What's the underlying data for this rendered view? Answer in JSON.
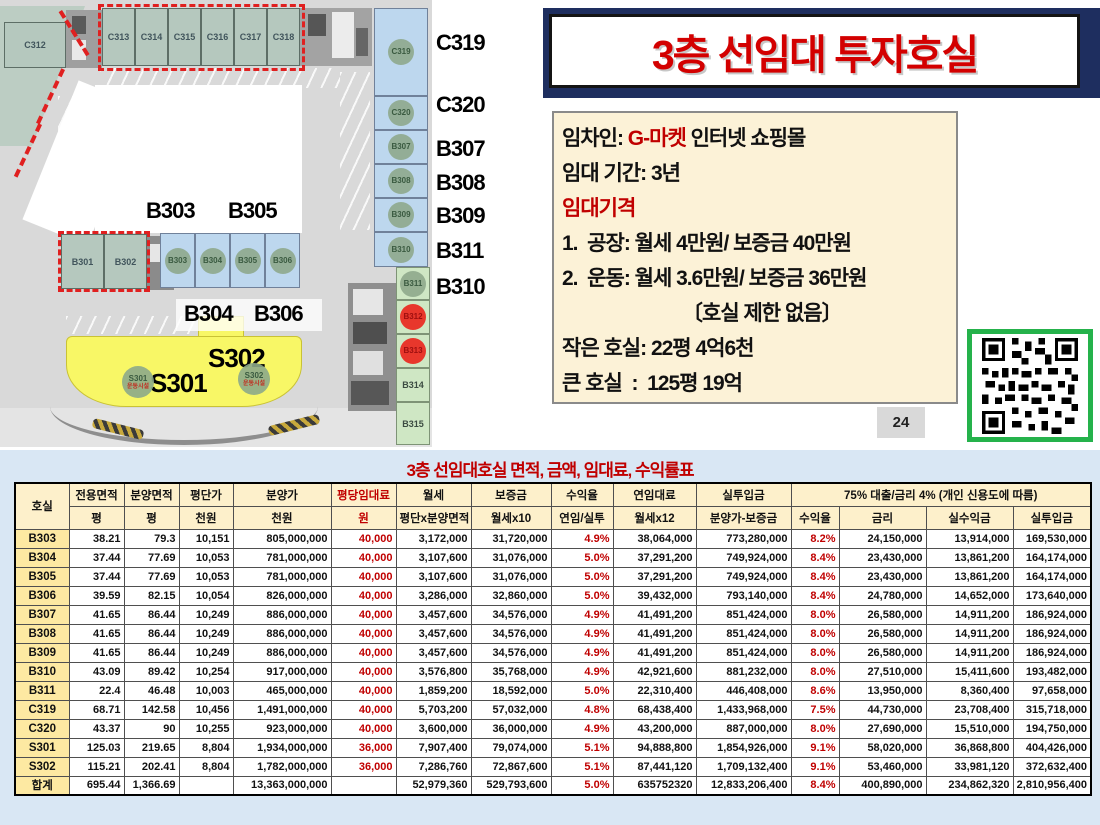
{
  "title": "3층 선임대 투자호실",
  "colors": {
    "title_red": "#d30000",
    "accent_red": "#c00000",
    "navy_frame": "#1e2e5f",
    "qr_border_green": "#25b24b",
    "info_bg": "#fcf2d7",
    "table_band_bg": "#d9e7f4",
    "header_cream": "#fdf0cb",
    "row_label_yellow": "#fde9a2"
  },
  "info_box": {
    "line1_label": "임차인: ",
    "line1_red": "G-마켓",
    "line1_rest": " 인터넷 쇼핑몰",
    "line2": "임대 기간: 3년",
    "line3": "임대기격",
    "line4": "1.  공장: 월세 4만원/ 보증금 40만원",
    "line5": "2.  운동: 월세 3.6만원/ 보증금 36만원",
    "line6": "〔호실 제한 없음〕",
    "line7": "작은 호실: 22평 4억6천",
    "line8": "큰 호실  :  125평 19억"
  },
  "page_number": "24",
  "qr_label": "상세보기",
  "floorplan": {
    "c312": "C312",
    "top_units": [
      "C313",
      "C314",
      "C315",
      "C316",
      "C317",
      "C318"
    ],
    "right_cells": [
      {
        "label": "C319",
        "kind": "blue-circle"
      },
      {
        "label": "C320",
        "kind": "blue-circle"
      },
      {
        "label": "B307",
        "kind": "blue-circle"
      },
      {
        "label": "B308",
        "kind": "blue-circle"
      },
      {
        "label": "B309",
        "kind": "blue-circle"
      },
      {
        "label": "B310",
        "kind": "blue-circle"
      },
      {
        "label": "B311",
        "kind": "green-circle"
      },
      {
        "label": "B312",
        "kind": "red-circle"
      },
      {
        "label": "B313",
        "kind": "red-circle"
      },
      {
        "label": "B314",
        "kind": "green-text"
      },
      {
        "label": "B315",
        "kind": "green-text"
      }
    ],
    "right_big_labels": [
      "C319",
      "C320",
      "B307",
      "B308",
      "B309",
      "B311",
      "B310"
    ],
    "inner_units": [
      "B303",
      "B304",
      "B305",
      "B306"
    ],
    "annex_units": [
      "B301",
      "B302"
    ],
    "label_b303": "B303",
    "label_b305": "B305",
    "label_b304": "B304",
    "label_b306": "B306",
    "s_units": [
      {
        "name": "S301",
        "sub": "운동시설"
      },
      {
        "name": "S302",
        "sub": "운동시설"
      }
    ],
    "label_s301": "S301",
    "label_s302": "S302"
  },
  "table": {
    "title": "3층 선임대호실 면적, 금액, 임대료, 수익률표",
    "group_header": "75% 대출/금리 4%  (개인 신용도에 따름)",
    "headers_row1": [
      "호실",
      "전용면적",
      "분양면적",
      "평단가",
      "분양가",
      "평당임대료",
      "월세",
      "보증금",
      "수익율",
      "연임대료",
      "실투입금"
    ],
    "headers_row2": [
      "평",
      "평",
      "천원",
      "천원",
      "원",
      "평단x분양면적",
      "월세x10",
      "연임/실투",
      "월세x12",
      "분양가-보증금",
      "수익율",
      "금리",
      "실수익금",
      "실투입금"
    ],
    "rows": [
      [
        "B303",
        "38.21",
        "79.3",
        "10,151",
        "805,000,000",
        "40,000",
        "3,172,000",
        "31,720,000",
        "4.9%",
        "38,064,000",
        "773,280,000",
        "8.2%",
        "24,150,000",
        "13,914,000",
        "169,530,000"
      ],
      [
        "B304",
        "37.44",
        "77.69",
        "10,053",
        "781,000,000",
        "40,000",
        "3,107,600",
        "31,076,000",
        "5.0%",
        "37,291,200",
        "749,924,000",
        "8.4%",
        "23,430,000",
        "13,861,200",
        "164,174,000"
      ],
      [
        "B305",
        "37.44",
        "77.69",
        "10,053",
        "781,000,000",
        "40,000",
        "3,107,600",
        "31,076,000",
        "5.0%",
        "37,291,200",
        "749,924,000",
        "8.4%",
        "23,430,000",
        "13,861,200",
        "164,174,000"
      ],
      [
        "B306",
        "39.59",
        "82.15",
        "10,054",
        "826,000,000",
        "40,000",
        "3,286,000",
        "32,860,000",
        "5.0%",
        "39,432,000",
        "793,140,000",
        "8.4%",
        "24,780,000",
        "14,652,000",
        "173,640,000"
      ],
      [
        "B307",
        "41.65",
        "86.44",
        "10,249",
        "886,000,000",
        "40,000",
        "3,457,600",
        "34,576,000",
        "4.9%",
        "41,491,200",
        "851,424,000",
        "8.0%",
        "26,580,000",
        "14,911,200",
        "186,924,000"
      ],
      [
        "B308",
        "41.65",
        "86.44",
        "10,249",
        "886,000,000",
        "40,000",
        "3,457,600",
        "34,576,000",
        "4.9%",
        "41,491,200",
        "851,424,000",
        "8.0%",
        "26,580,000",
        "14,911,200",
        "186,924,000"
      ],
      [
        "B309",
        "41.65",
        "86.44",
        "10,249",
        "886,000,000",
        "40,000",
        "3,457,600",
        "34,576,000",
        "4.9%",
        "41,491,200",
        "851,424,000",
        "8.0%",
        "26,580,000",
        "14,911,200",
        "186,924,000"
      ],
      [
        "B310",
        "43.09",
        "89.42",
        "10,254",
        "917,000,000",
        "40,000",
        "3,576,800",
        "35,768,000",
        "4.9%",
        "42,921,600",
        "881,232,000",
        "8.0%",
        "27,510,000",
        "15,411,600",
        "193,482,000"
      ],
      [
        "B311",
        "22.4",
        "46.48",
        "10,003",
        "465,000,000",
        "40,000",
        "1,859,200",
        "18,592,000",
        "5.0%",
        "22,310,400",
        "446,408,000",
        "8.6%",
        "13,950,000",
        "8,360,400",
        "97,658,000"
      ],
      [
        "C319",
        "68.71",
        "142.58",
        "10,456",
        "1,491,000,000",
        "40,000",
        "5,703,200",
        "57,032,000",
        "4.8%",
        "68,438,400",
        "1,433,968,000",
        "7.5%",
        "44,730,000",
        "23,708,400",
        "315,718,000"
      ],
      [
        "C320",
        "43.37",
        "90",
        "10,255",
        "923,000,000",
        "40,000",
        "3,600,000",
        "36,000,000",
        "4.9%",
        "43,200,000",
        "887,000,000",
        "8.0%",
        "27,690,000",
        "15,510,000",
        "194,750,000"
      ],
      [
        "S301",
        "125.03",
        "219.65",
        "8,804",
        "1,934,000,000",
        "36,000",
        "7,907,400",
        "79,074,000",
        "5.1%",
        "94,888,800",
        "1,854,926,000",
        "9.1%",
        "58,020,000",
        "36,868,800",
        "404,426,000"
      ],
      [
        "S302",
        "115.21",
        "202.41",
        "8,804",
        "1,782,000,000",
        "36,000",
        "7,286,760",
        "72,867,600",
        "5.1%",
        "87,441,120",
        "1,709,132,400",
        "9.1%",
        "53,460,000",
        "33,981,120",
        "372,632,400"
      ],
      [
        "합계",
        "695.44",
        "1,366.69",
        "",
        "13,363,000,000",
        "",
        "52,979,360",
        "529,793,600",
        "5.0%",
        "635752320",
        "12,833,206,400",
        "8.4%",
        "400,890,000",
        "234,862,320",
        "2,810,956,400"
      ]
    ]
  }
}
